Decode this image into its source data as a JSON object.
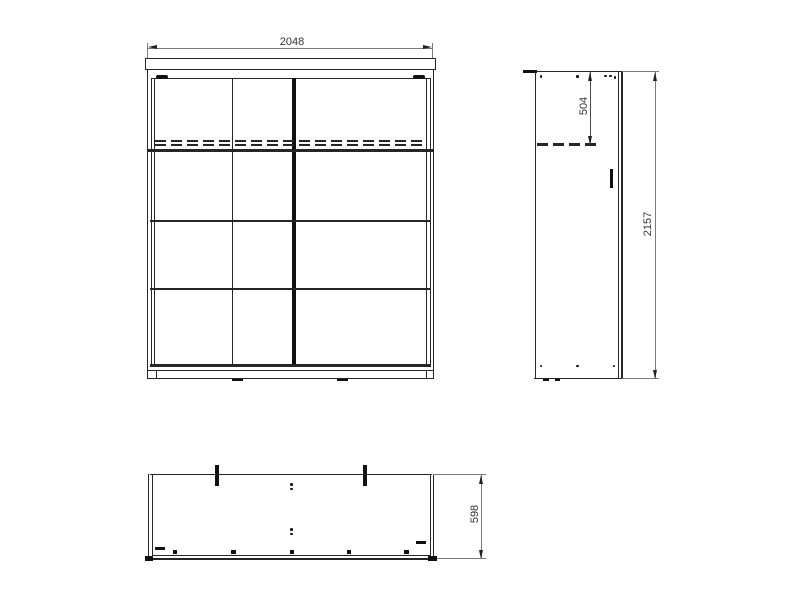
{
  "drawing": {
    "front_view": {
      "width_dim": "2048"
    },
    "side_view": {
      "rail_height_dim": "504",
      "total_height_dim": "2157"
    },
    "plan_view": {
      "depth_dim": "598"
    }
  },
  "colors": {
    "body_line": "#262626",
    "dim_line": "#7a7a7a",
    "text": "#333333",
    "background": "#ffffff"
  }
}
